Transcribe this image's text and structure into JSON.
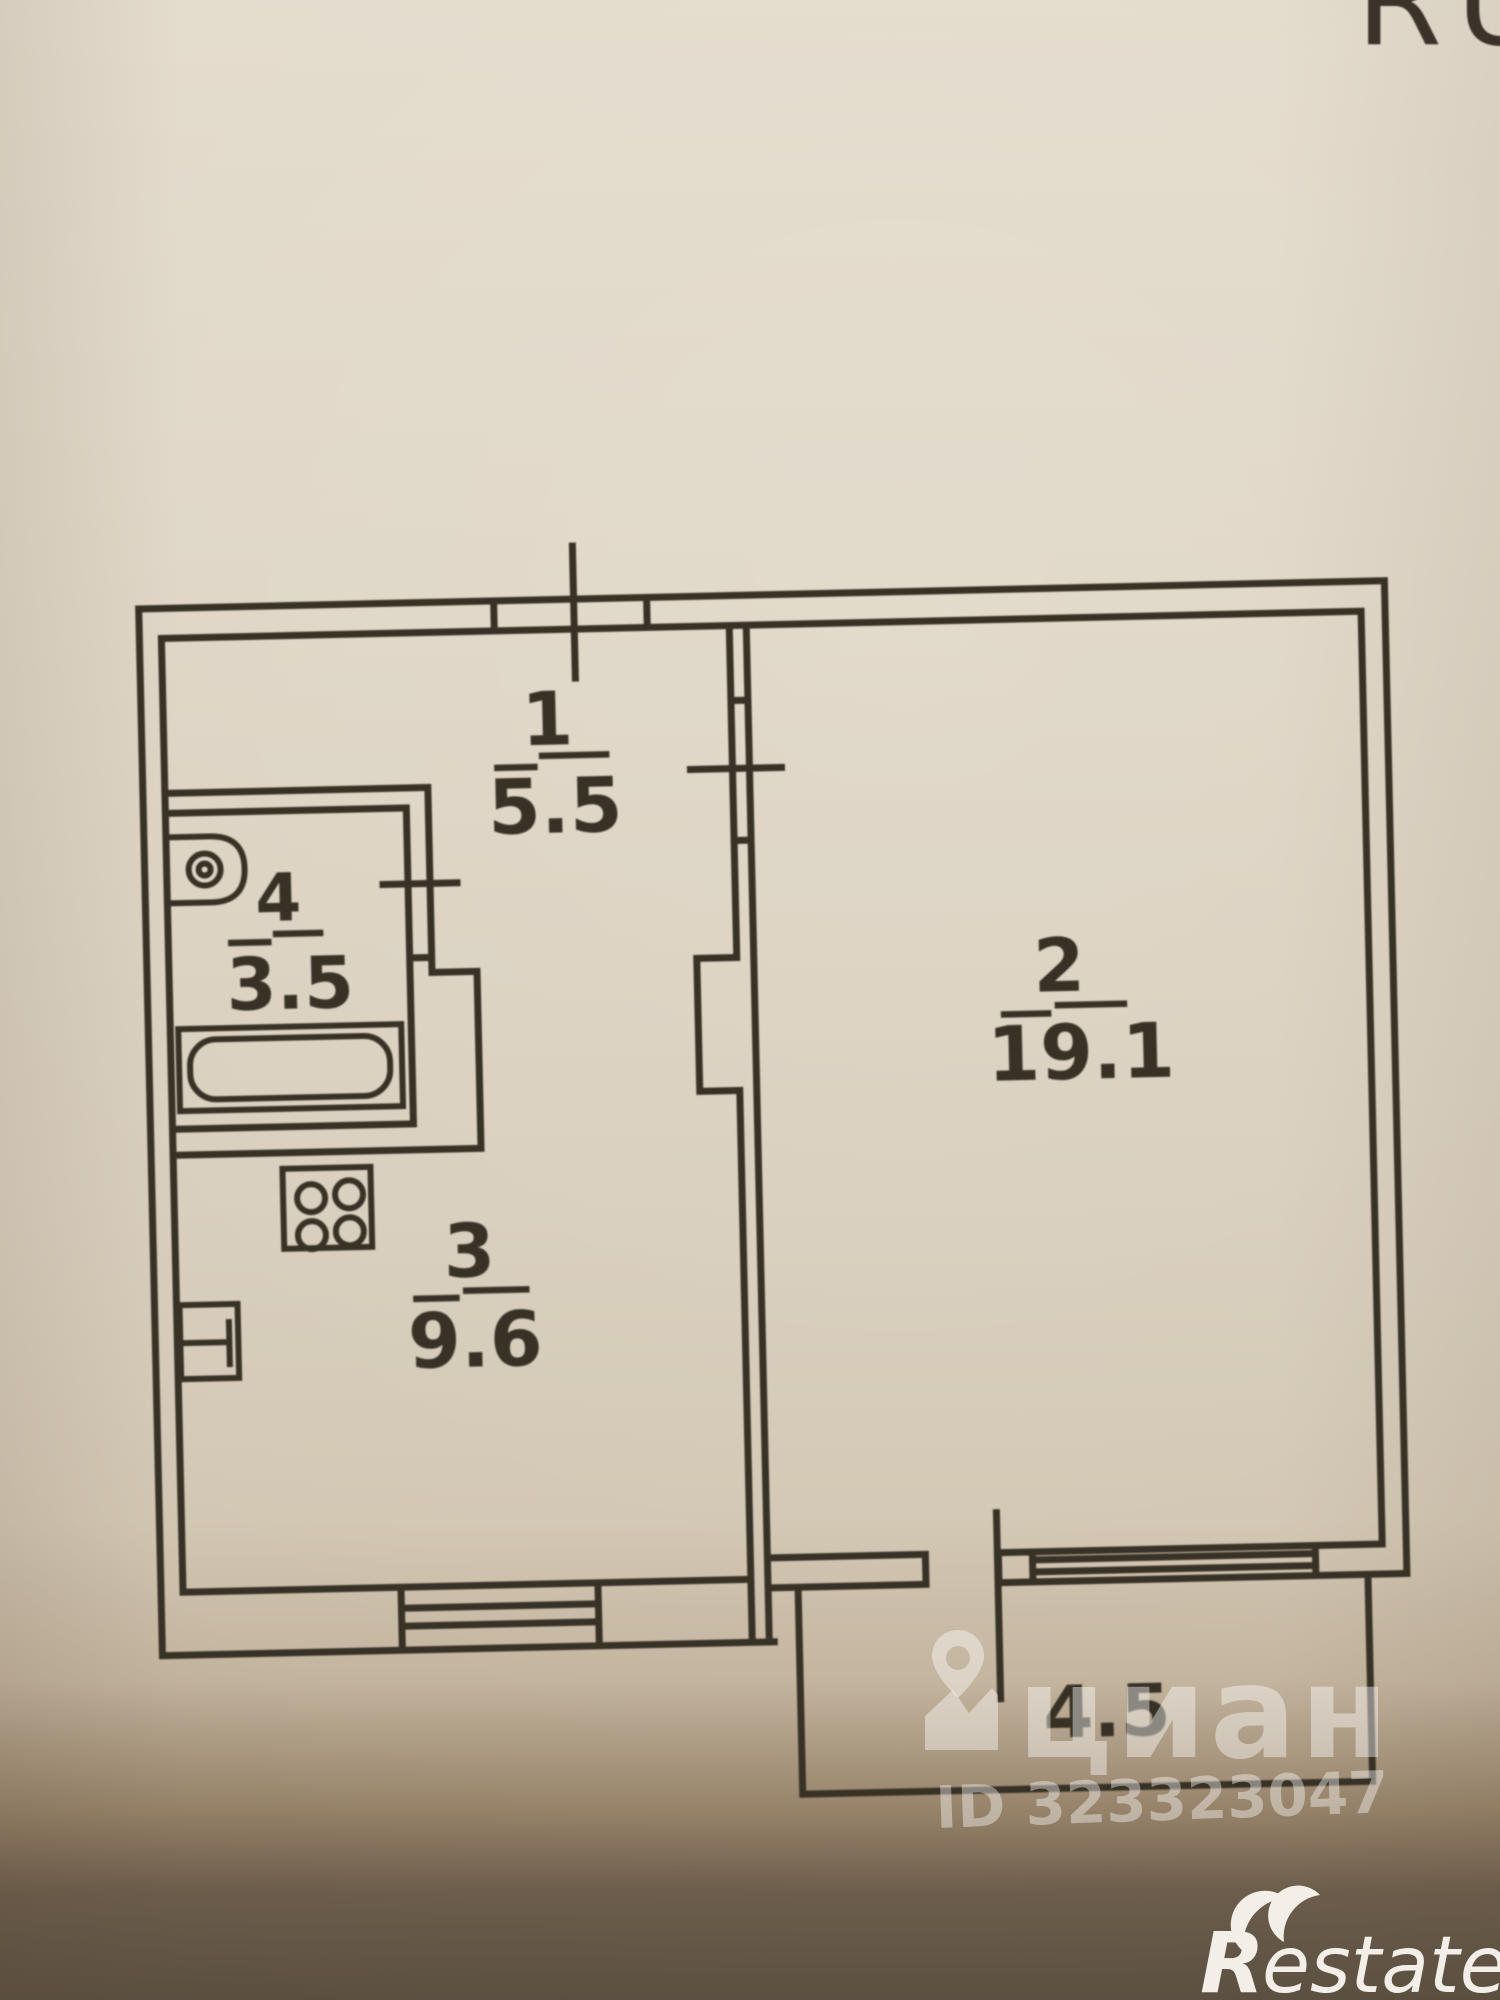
{
  "corner": {
    "text": "RU"
  },
  "rooms": [
    {
      "number": "1",
      "area": "5.5"
    },
    {
      "number": "2",
      "area": "19.1"
    },
    {
      "number": "3",
      "area": "9.6"
    },
    {
      "number": "4",
      "area": "3.5"
    }
  ],
  "balcony": {
    "area": "4.5"
  },
  "watermark": {
    "brand": "циан",
    "listing_id": "ID 323323047"
  },
  "footer": {
    "logo_initial": "R",
    "logo_suffix": "estate"
  },
  "colors": {
    "paper": "#d9cfbf",
    "ink": "#383027",
    "watermark_white": "#ffffff",
    "photo_bottom_band": "#5c5142"
  }
}
